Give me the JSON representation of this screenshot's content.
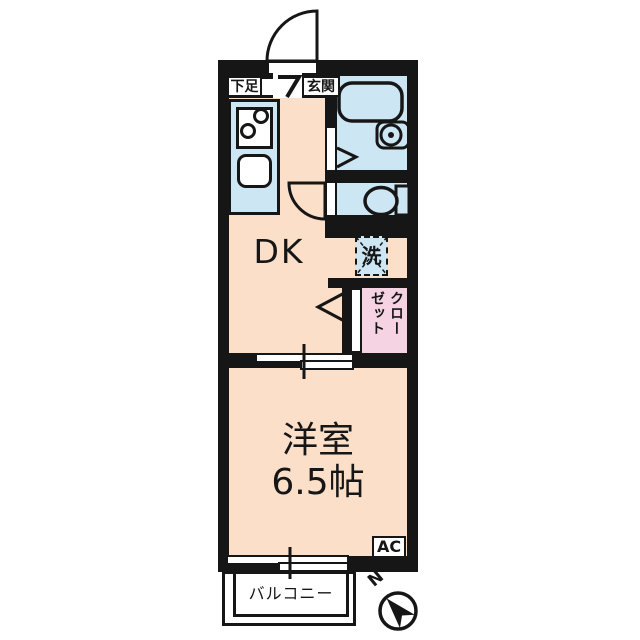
{
  "floorplan": {
    "title": "1DK apartment floor plan",
    "labels": {
      "shoe_storage": "下足",
      "entrance": "玄関",
      "dining_kitchen": "DK",
      "washer": "洗",
      "closet_line1": "クロー",
      "closet_line2": "ゼット",
      "main_room_name": "洋室",
      "main_room_size": "6.5帖",
      "air_conditioner": "AC",
      "balcony": "バルコニー",
      "compass_north": "N"
    },
    "colors": {
      "bg": "#ffffff",
      "wall": "#161616",
      "floor": "#fbdfc8",
      "wet": "#cde6f3",
      "closet": "#f6d3e2"
    }
  }
}
